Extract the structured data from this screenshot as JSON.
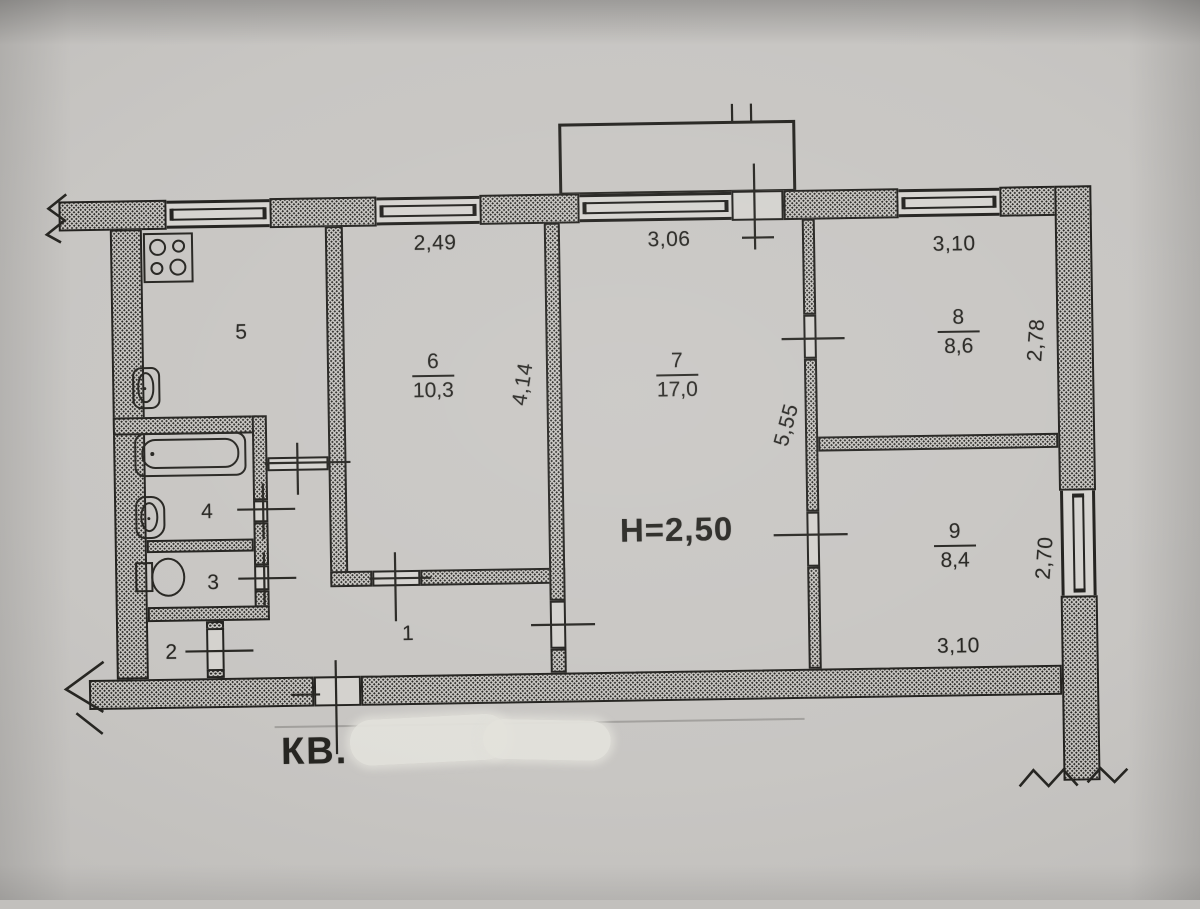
{
  "plan": {
    "apartment_label": "КВ.",
    "ceiling_height_label": "Н=2,50",
    "rooms": {
      "r1": {
        "number": "1"
      },
      "r2": {
        "number": "2"
      },
      "r3": {
        "number": "3"
      },
      "r4": {
        "number": "4"
      },
      "r5": {
        "number": "5"
      },
      "r6": {
        "number": "6",
        "area": "10,3",
        "width": "2,49",
        "depth": "4,14"
      },
      "r7": {
        "number": "7",
        "area": "17,0",
        "width": "3,06"
      },
      "r8": {
        "number": "8",
        "area": "8,6",
        "width": "3,10",
        "depth": "2,78"
      },
      "r9": {
        "number": "9",
        "area": "8,4",
        "width": "3,10",
        "depth": "2,70"
      },
      "hallway": {
        "depth": "5,55"
      }
    }
  }
}
